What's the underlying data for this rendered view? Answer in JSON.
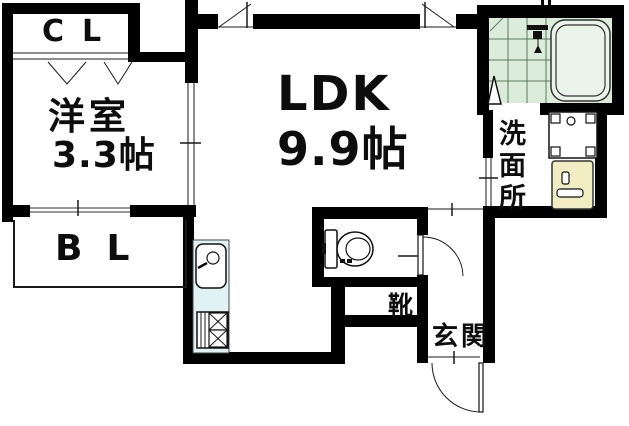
{
  "page": {
    "type": "apartment-floor-plan"
  },
  "rooms": {
    "closet": {
      "label": "CL"
    },
    "western_room": {
      "name": "洋室",
      "size": "3.3帖"
    },
    "ldk": {
      "name": "LDK",
      "size": "9.9帖"
    },
    "balcony": {
      "label": "BL"
    },
    "washroom": {
      "label": "洗面所"
    },
    "shoe_cabinet": {
      "label": "靴"
    },
    "entrance": {
      "label": "玄関"
    }
  },
  "fixtures": [
    "bathtub",
    "shower-mixer",
    "bath-folding-door",
    "washing-machine-pan",
    "washbasin",
    "toilet",
    "kitchen-sink",
    "gas-stove",
    "closet-folding-doors",
    "entry-door-swing",
    "toilet-door-swing",
    "sliding-door-partition",
    "balcony-window",
    "top-wall-windows"
  ],
  "colors": {
    "wall": "#000000",
    "bath_tile": "#dcecdb",
    "tub": "#eaf4ea",
    "kitchen_counter": "#e1f2f4",
    "washbasin": "#f1ecc2"
  }
}
